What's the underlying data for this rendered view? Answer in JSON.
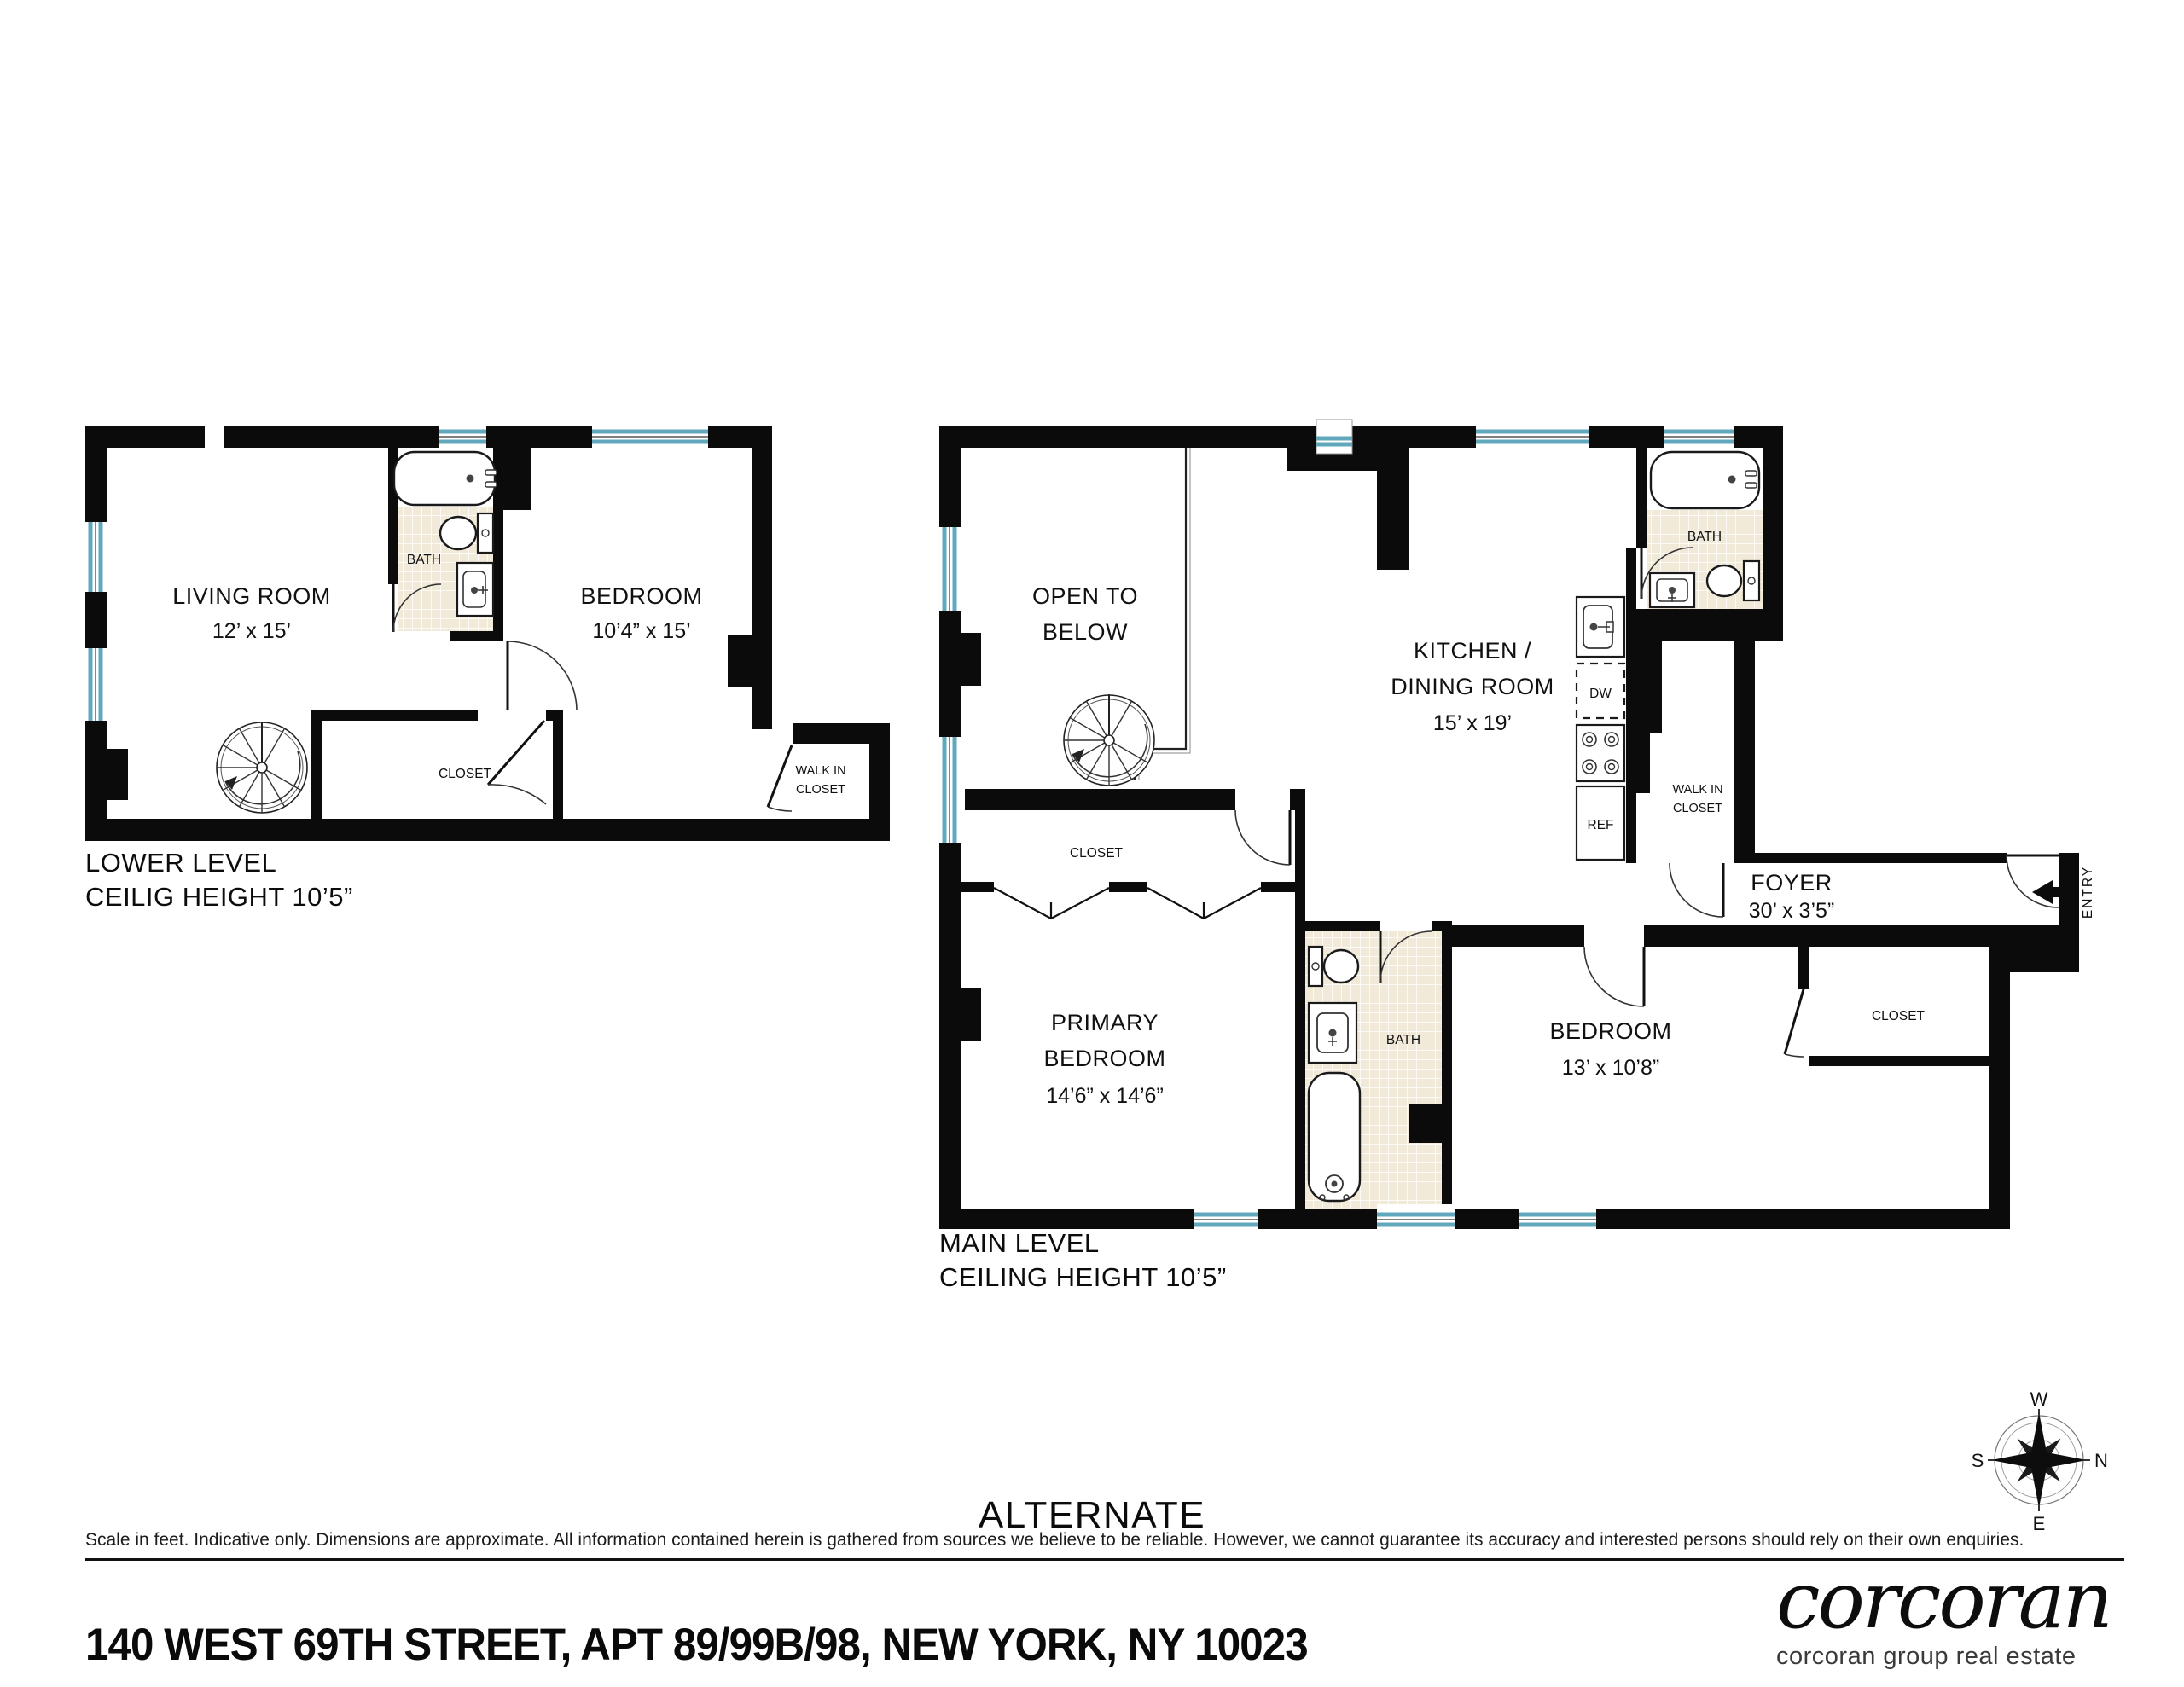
{
  "colors": {
    "wall": "#0B0B0B",
    "window_blue": "#62A8BC",
    "tile_fill": "#F2EAD8"
  },
  "lower_level": {
    "caption_line1": "LOWER LEVEL",
    "caption_line2": "CEILIG HEIGHT 10’5”",
    "living_room": {
      "name": "LIVING ROOM",
      "dims": "12’ x 15’"
    },
    "bedroom": {
      "name": "BEDROOM",
      "dims": "10’4” x 15’"
    },
    "bath_label": "BATH",
    "closet_label": "CLOSET",
    "walk_in_line1": "WALK IN",
    "walk_in_line2": "CLOSET"
  },
  "main_level": {
    "caption_line1": "MAIN LEVEL",
    "caption_line2": "CEILING HEIGHT 10’5”",
    "open_to_below_line1": "OPEN TO",
    "open_to_below_line2": "BELOW",
    "kitchen_line1": "KITCHEN /",
    "kitchen_line2": "DINING ROOM",
    "kitchen_dims": "15’ x 19’",
    "bath_upper_label": "BATH",
    "dishwasher_label": "DW",
    "refrigerator_label": "REF",
    "walk_in_line1": "WALK IN",
    "walk_in_line2": "CLOSET",
    "foyer": {
      "name": "FOYER",
      "dims": "30’ x 3’5”"
    },
    "entry_label": "ENTRY",
    "closet_label": "CLOSET",
    "primary_bedroom": {
      "line1": "PRIMARY",
      "line2": "BEDROOM",
      "dims": "14’6” x 14’6”"
    },
    "bath_lower_label": "BATH",
    "bedroom": {
      "name": "BEDROOM",
      "dims": "13’ x 10’8”"
    },
    "closet_right_label": "CLOSET"
  },
  "compass": {
    "top": "W",
    "right": "N",
    "bottom": "E",
    "left": "S"
  },
  "footer": {
    "variant_label": "ALTERNATE",
    "disclaimer": "Scale in feet. Indicative only. Dimensions are approximate. All information contained herein is gathered from sources we believe to be reliable. However, we cannot guarantee its accuracy and interested persons should rely on their own enquiries.",
    "address": "140 WEST 69TH STREET, APT 89/99B/98, NEW YORK, NY 10023",
    "brand": "corcoran",
    "brand_tagline": "corcoran group real estate"
  }
}
